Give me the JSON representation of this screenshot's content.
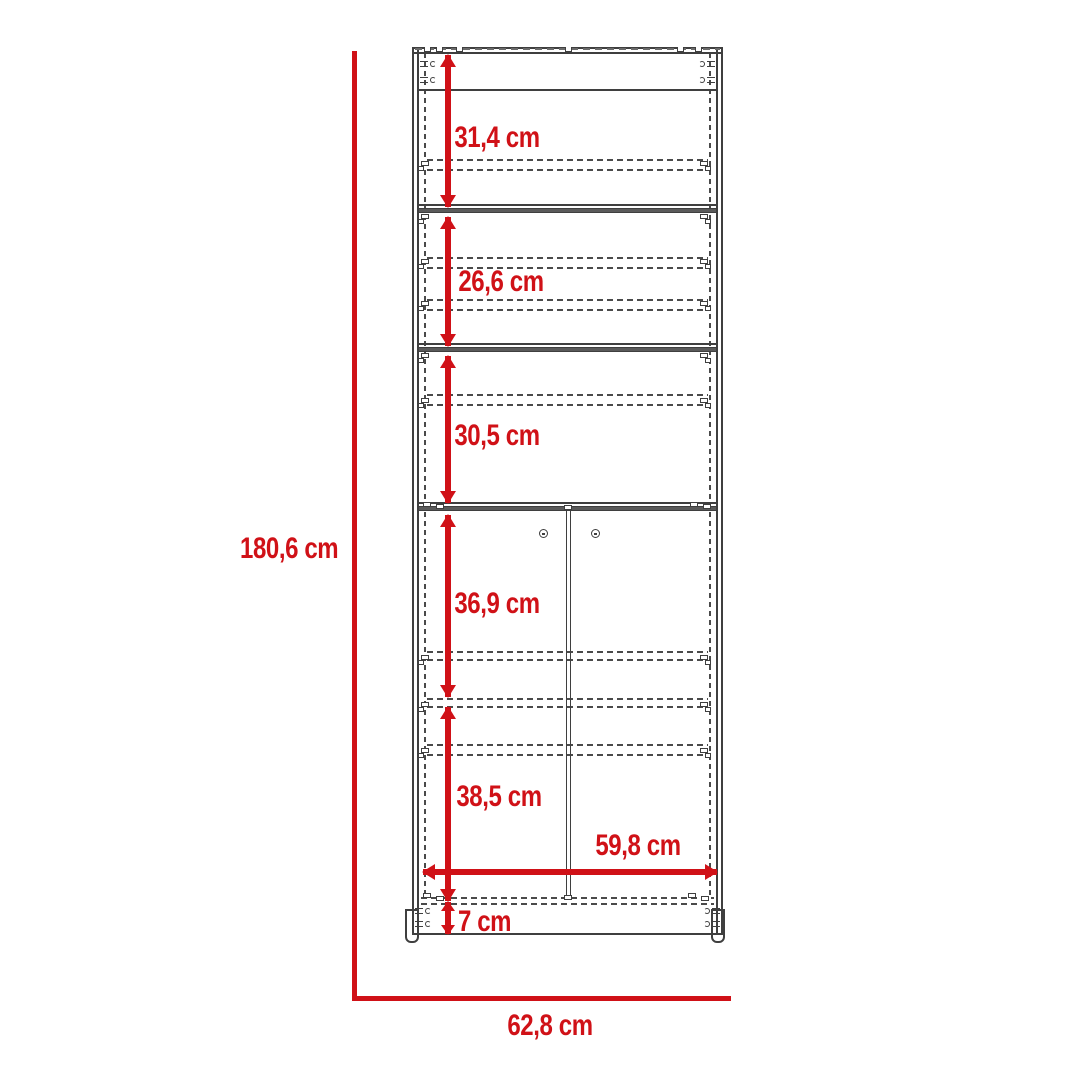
{
  "diagram": {
    "title": "cabinet front elevation with dimensions",
    "units": "cm",
    "accent_color": "#d01117",
    "line_color": "#3f3f3f",
    "overall": {
      "height": {
        "value": 180.6,
        "label": "180,6 cm"
      },
      "width": {
        "value": 62.8,
        "label": "62,8 cm"
      }
    },
    "sections": [
      {
        "name": "upper-shelf-opening",
        "value": 31.4,
        "label": "31,4 cm"
      },
      {
        "name": "second-shelf-opening",
        "value": 26.6,
        "label": "26,6 cm"
      },
      {
        "name": "third-shelf-opening",
        "value": 30.5,
        "label": "30,5 cm"
      },
      {
        "name": "door-upper-opening",
        "value": 36.9,
        "label": "36,9 cm"
      },
      {
        "name": "door-lower-opening",
        "value": 38.5,
        "label": "38,5 cm"
      }
    ],
    "interior_width": {
      "value": 59.8,
      "label": "59,8 cm"
    },
    "base_height": {
      "value": 7,
      "label": "7 cm"
    }
  }
}
